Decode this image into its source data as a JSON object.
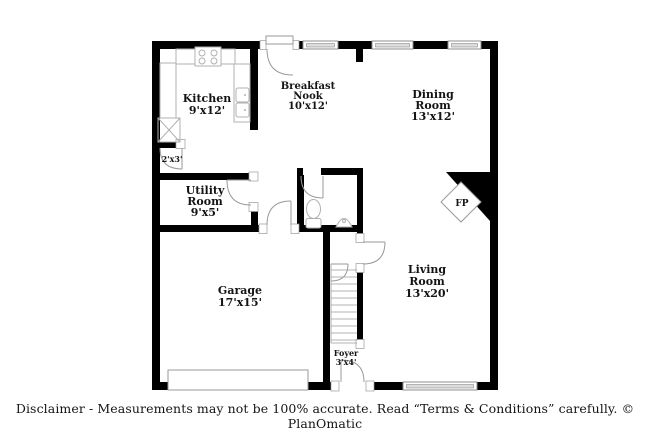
{
  "plan": {
    "colors": {
      "wall": "#000000",
      "fixture_line": "#9a9a9a",
      "text": "#141414"
    },
    "rooms": {
      "kitchen": {
        "lines": [
          "Kitchen",
          "9'x12'"
        ]
      },
      "breakfast_nook": {
        "lines": [
          "Breakfast",
          "Nook",
          "10'x12'"
        ]
      },
      "dining_room": {
        "lines": [
          "Dining",
          "Room",
          "13'x12'"
        ]
      },
      "closet": {
        "lines": [
          "2'x3'"
        ]
      },
      "utility_room": {
        "lines": [
          "Utility",
          "Room",
          "9'x5'"
        ]
      },
      "garage": {
        "lines": [
          "Garage",
          "17'x15'"
        ]
      },
      "living_room": {
        "lines": [
          "Living",
          "Room",
          "13'x20'"
        ]
      },
      "foyer": {
        "lines": [
          "Foyer",
          "3'x4'"
        ]
      },
      "fireplace": {
        "lines": [
          "FP"
        ]
      }
    }
  },
  "footer": {
    "disclaimer": "Disclaimer - Measurements may not be 100% accurate. Read “Terms & Conditions” carefully. © PlanOmatic"
  }
}
